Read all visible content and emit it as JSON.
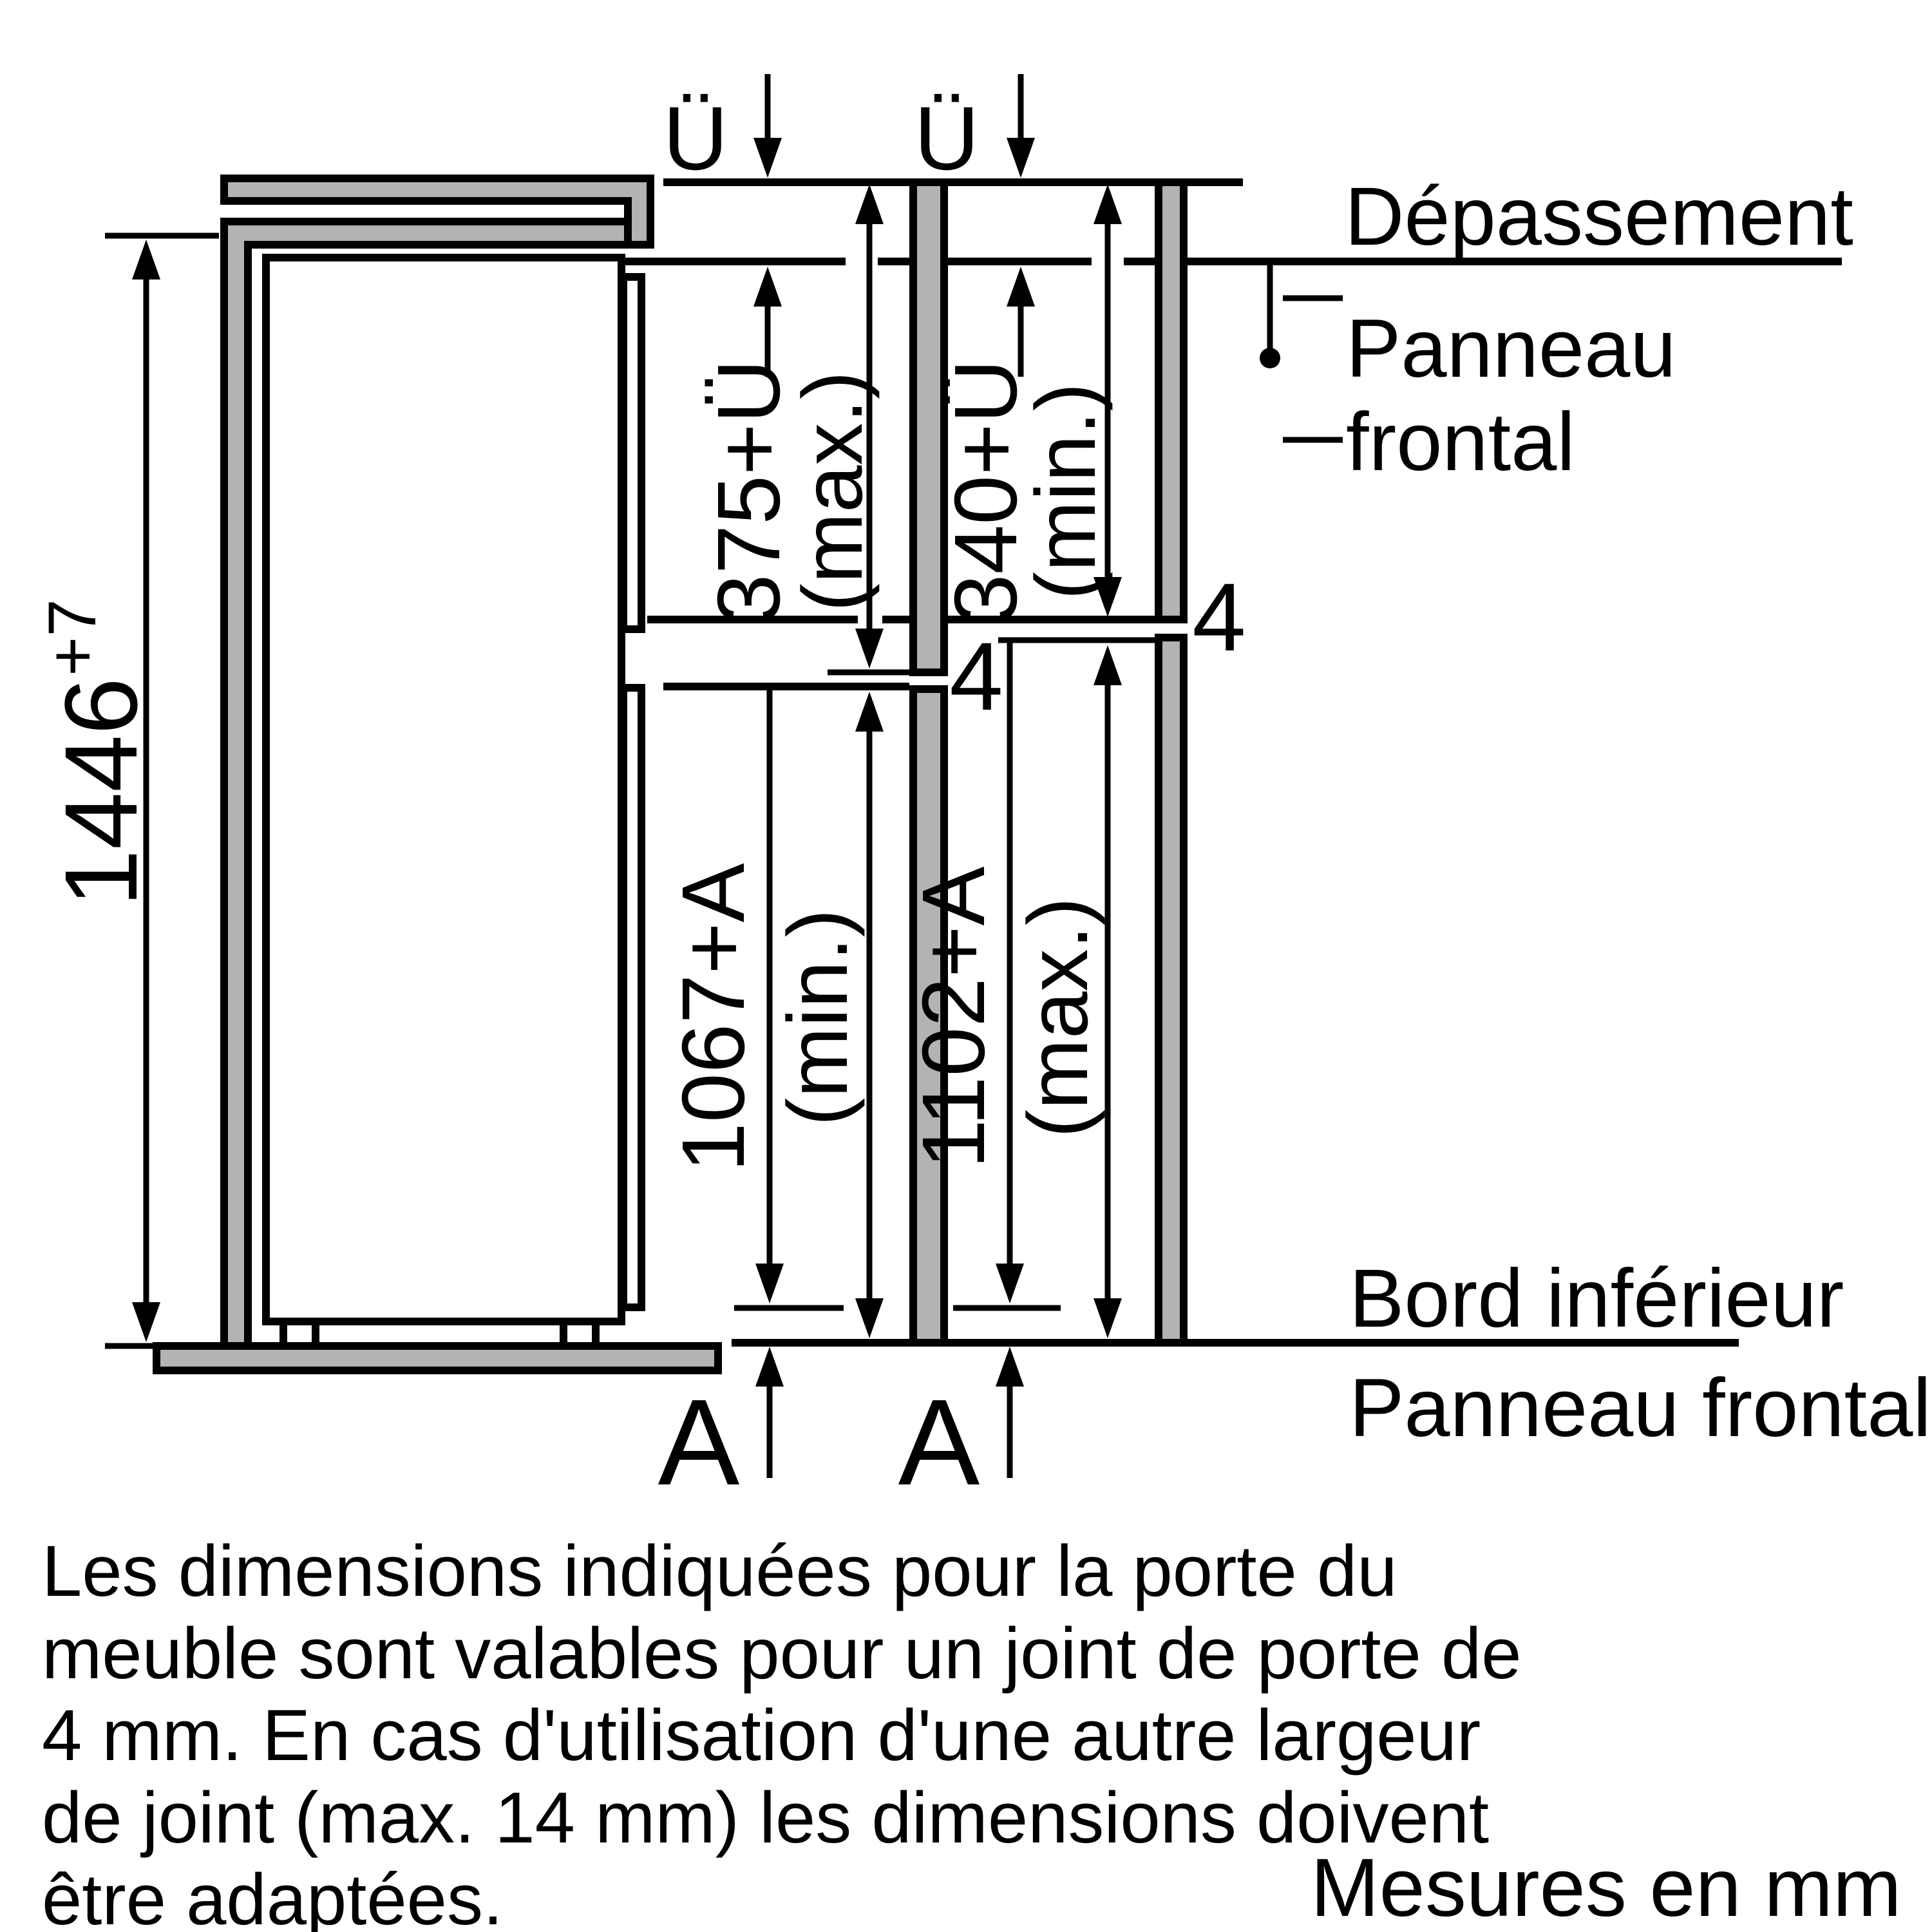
{
  "diagram": {
    "type": "appliance-installation-drawing",
    "unit_note": "Mesures en mm",
    "callouts": {
      "depassement": "Dépassement",
      "panneau_frontal_top_line1": "Panneau",
      "panneau_frontal_top_line2": "frontal",
      "bord_inferieur": "Bord inférieur",
      "panneau_frontal_bottom": "Panneau frontal"
    },
    "dimensions": {
      "niche_height": "1446",
      "niche_height_tolerance": "+7",
      "overhang_symbol_left": "Ü",
      "overhang_symbol_right": "Ü",
      "upper_door_max": "375+Ü",
      "upper_door_max_qualifier": "(max.)",
      "upper_door_min": "340+Ü",
      "upper_door_min_qualifier": "(min.)",
      "lower_door_min": "1067+A",
      "lower_door_min_qualifier": "(min.)",
      "lower_door_max": "1102+A",
      "lower_door_max_qualifier": "(max.)",
      "door_gap_left": "4",
      "door_gap_right": "4",
      "adjust_symbol_left": "A",
      "adjust_symbol_right": "A"
    },
    "note_lines": [
      "Les dimensions indiquées pour la porte du",
      "meuble sont valables pour un joint de porte de",
      "4 mm. En cas d'utilisation d'une autre largeur",
      "de joint (max. 14 mm) les dimensions doivent",
      "être adaptées."
    ],
    "colors": {
      "line": "#000000",
      "panel_fill": "#b3b3b3",
      "background": "#ffffff"
    }
  }
}
